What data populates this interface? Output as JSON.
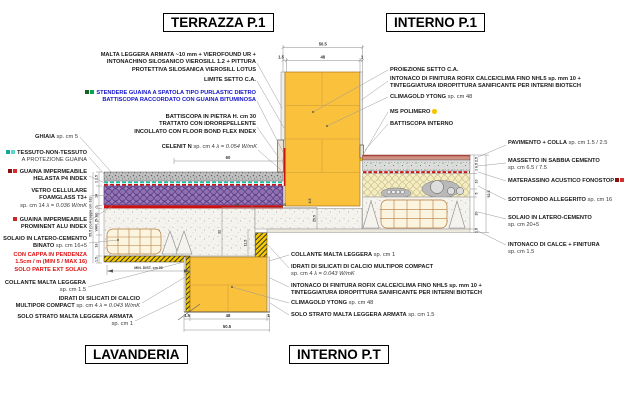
{
  "titles": {
    "terrazza": "TERRAZZA P.1",
    "interno_p1": "INTERNO P.1",
    "lavanderia": "LAVANDERIA",
    "interno_pt": "INTERNO P.T"
  },
  "left_labels": {
    "malta": {
      "l1": "MALTA LEGGERA ARMATA ~10 mm +  VIEROFOUND UR +",
      "l2": "INTONACHINO SILOSANICO VIEROSILL 1.2 + PITTURA",
      "l3": "PROTETTIVA SILOSANICA VIEROSILL LOTUS"
    },
    "limite": {
      "l1": "LIMITE SETTO C.A."
    },
    "stendere": {
      "l1": "STENDERE GUAINA A SPATOLA TIPO PURLASTIC DIETRO",
      "l2": "BATTISCOPA RACCORDATO CON GUAINA BITUMINOSA"
    },
    "battiscopa_pietra": {
      "l1": "BATTISCOPA IN PIETRA H. cm 30",
      "l2": "TRATTATO CON IDROREPELLENTE",
      "l3": "INCOLLATO CON FLOOR BOND FLEX INDEX"
    },
    "ghiaia": {
      "b": "GHIAIA",
      "r": " sp. cm 5"
    },
    "celenit": {
      "b": "CELENIT N",
      "r": " sp. cm 4 ",
      "i": "λ = 0.054 W/mK"
    },
    "tessuto": {
      "l1": "TESSUTO-NON-TESSUTO",
      "l2": "A PROTEZIONE GUAINA"
    },
    "helasta": {
      "l1": "GUAINA IMPERMEABILE",
      "l2": "HELASTA P4 INDEX"
    },
    "vetro": {
      "l1": "VETRO CELLULARE",
      "l2": "FOAMGLASS T3+",
      "r": "sp. cm 14 ",
      "i": "λ = 0.036 W/mK"
    },
    "prominent": {
      "l1": "GUAINA IMPERMEABILE",
      "l2": "PROMINENT ALU INDEX"
    },
    "solaio_binato": {
      "l1": "SOLAIO IN LATERO-CEMENTO",
      "l2b": "BINATO",
      "l2r": " sp. cm 16+5"
    },
    "cappa": {
      "l1": "CON CAPPA IN PENDENZA",
      "l2": "1.5cm / m (MIN 5 / MAX 16)",
      "l3": "SOLO PARTE EXT SOLAIO"
    },
    "collante_lav": {
      "l1": "COLLANTE MALTA LEGGERA",
      "r": "sp. cm 1.5"
    },
    "idrati_lav": {
      "l1": "IDRATI DI SILICATI DI CALCIO",
      "l2b": "MULTIPOR COMPACT",
      "l2r": " sp. cm 4 ",
      "l2i": "λ = 0.043 W/mK"
    },
    "solo_lav": {
      "l1": "SOLO STRATO MALTA LEGGERA ARMATA",
      "r": "sp. cm 1"
    }
  },
  "right_labels": {
    "proiezione": {
      "l1": "PROIEZIONE SETTO C.A."
    },
    "intonaco_p1": {
      "l1": "INTONACO DI FINITURA ROFIX CALCE/CLIMA FINO NHL5 sp. mm 10 +",
      "l2": "TINTEGGIATURA IDROPITTURA SANIFICANTE PER INTERNI BIOTECH"
    },
    "climagold_p1": {
      "b": "CLIMAGOLD YTONG",
      "r": " sp. cm 48"
    },
    "ms_polimero": {
      "b": "MS POLIMERO"
    },
    "battiscopa_int": {
      "b": "BATTISCOPA INTERNO"
    },
    "pavimento": {
      "b": "PAVIMENTO + COLLA",
      "r": " sp. cm 1.5 / 2.5"
    },
    "massetto": {
      "l1": "MASSETTO IN SABBIA CEMENTO",
      "r": "sp. cm 6.5 / 7.5"
    },
    "materassino": {
      "b": "MATERASSINO ACUSTICO FONOSTOP"
    },
    "sottofondo": {
      "b": "SOTTOFONDO ALLEGERITO",
      "r": " sp. cm 16"
    },
    "solaio_pt": {
      "l1": "SOLAIO IN LATERO-CEMENTO",
      "r": "sp. cm 20+5"
    },
    "intonaco_calce": {
      "l1": "INTONACO DI CALCE + FINITURA",
      "r": "sp. cm 1.5"
    }
  },
  "bottom_labels": {
    "collante_pt": {
      "b": "COLLANTE MALTA LEGGERA",
      "r": " sp. cm 1"
    },
    "idrati_pt": {
      "l1": "IDRATI DI SILICATI DI CALCIO MULTIPOR COMPACT",
      "r": "sp. cm 4 ",
      "i": "λ = 0.043 W/mK"
    },
    "intonaco_pt": {
      "l1": "INTONACO DI FINITURA ROFIX CALCE/CLIMA FINO NHL5 sp. mm 10 +",
      "l2": "TINTEGGIATURA IDROPITTURA SANIFICANTE PER INTERNI BIOTECH"
    },
    "climagold_pt": {
      "b": "CLIMAGOLD YTONG",
      "r": " sp. cm 48"
    },
    "solo_pt": {
      "b": "SOLO STRATO MALTA LEGGERA ARMATA",
      "r": " sp. cm 1.5"
    }
  },
  "dims": {
    "top_total": "50.5",
    "top_a": "1.5",
    "top_b": "48",
    "top_c": "1",
    "celenit_width": "60",
    "left_total": "55.5 (con cappa cm 16)",
    "left_a": "1 1.5",
    "left_b": "14",
    "left_c": "1",
    "left_d": "VAR. (5-16)",
    "left_e": "16",
    "left_f": "1.5",
    "slab_a": "25",
    "slab_b": "35",
    "slab_c": "32",
    "slab_d": "11.5",
    "slab_e": "25.5",
    "slab_f": "4.5",
    "min_dist": "MIN. DIST. cm 90",
    "bot_a": "1.5",
    "bot_b": "48",
    "bot_c": "1",
    "bot_total": "50.5",
    "right_a": "1 6.5 2.5",
    "right_b": "10",
    "right_c": "5",
    "right_d": "20",
    "right_e": "1.5",
    "right_total": "52.5"
  },
  "colors": {
    "wall_yellow": "#f9c13c",
    "foamglass_purple": "#9b7ebb",
    "guaina_red": "#cc1111",
    "tessuto_teal": "#17bfae",
    "note_blue": "#1414cc",
    "note_red": "#dd1111",
    "marker_green": "#00a651",
    "marker_dark_green": "#1b5e20",
    "marker_yellow": "#f5c400",
    "leader_gray": "#999999",
    "honeycomb_sand": "#f7f1ce",
    "pavimento_pink": "#ce9184"
  }
}
